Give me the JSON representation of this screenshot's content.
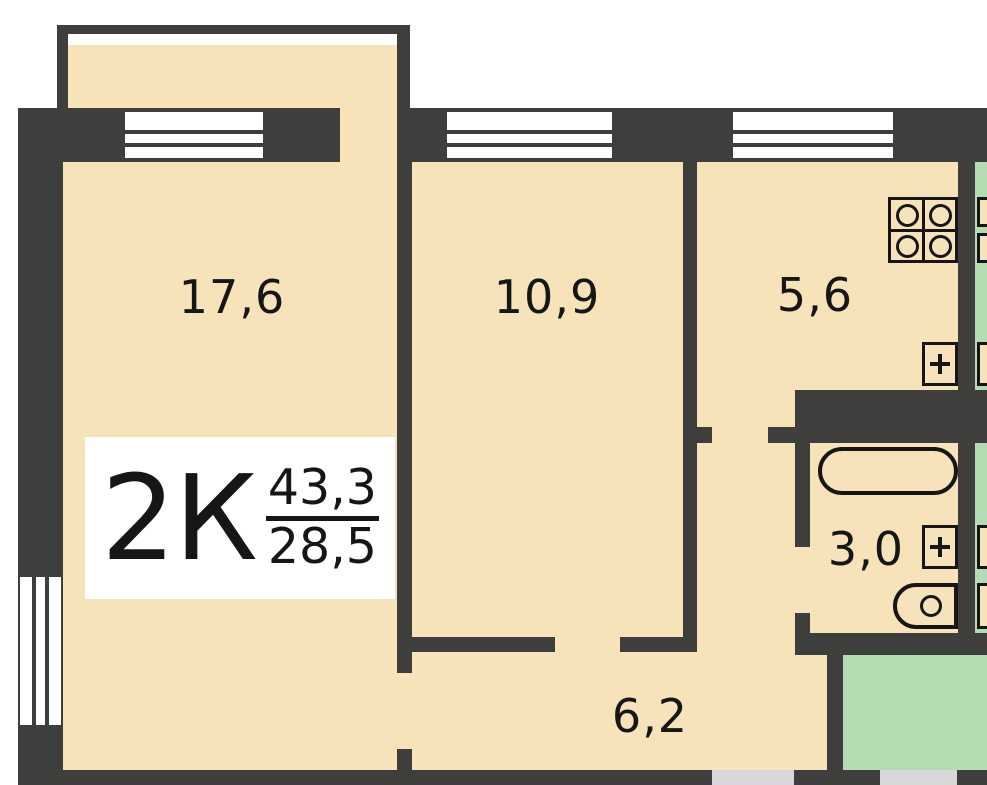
{
  "plan": {
    "title": "2К",
    "total_area": "43,3",
    "living_area": "28,5",
    "rooms": [
      {
        "name": "living-room",
        "area": "17,6"
      },
      {
        "name": "bedroom",
        "area": "10,9"
      },
      {
        "name": "kitchen",
        "area": "5,6"
      },
      {
        "name": "bathroom",
        "area": "3,0"
      },
      {
        "name": "hallway",
        "area": "6,2"
      }
    ],
    "fixtures": [
      "stove",
      "kitchen-sink",
      "bathtub",
      "bathroom-sink",
      "toilet"
    ],
    "colors": {
      "wall": "#3e3e3c",
      "room_fill": "#f6e3ba",
      "balcony_fill": "#b3dcb2",
      "doorway": "#d8d8db",
      "window": "#ffffff",
      "label_bg": "#ffffff",
      "ink": "#161616"
    }
  }
}
